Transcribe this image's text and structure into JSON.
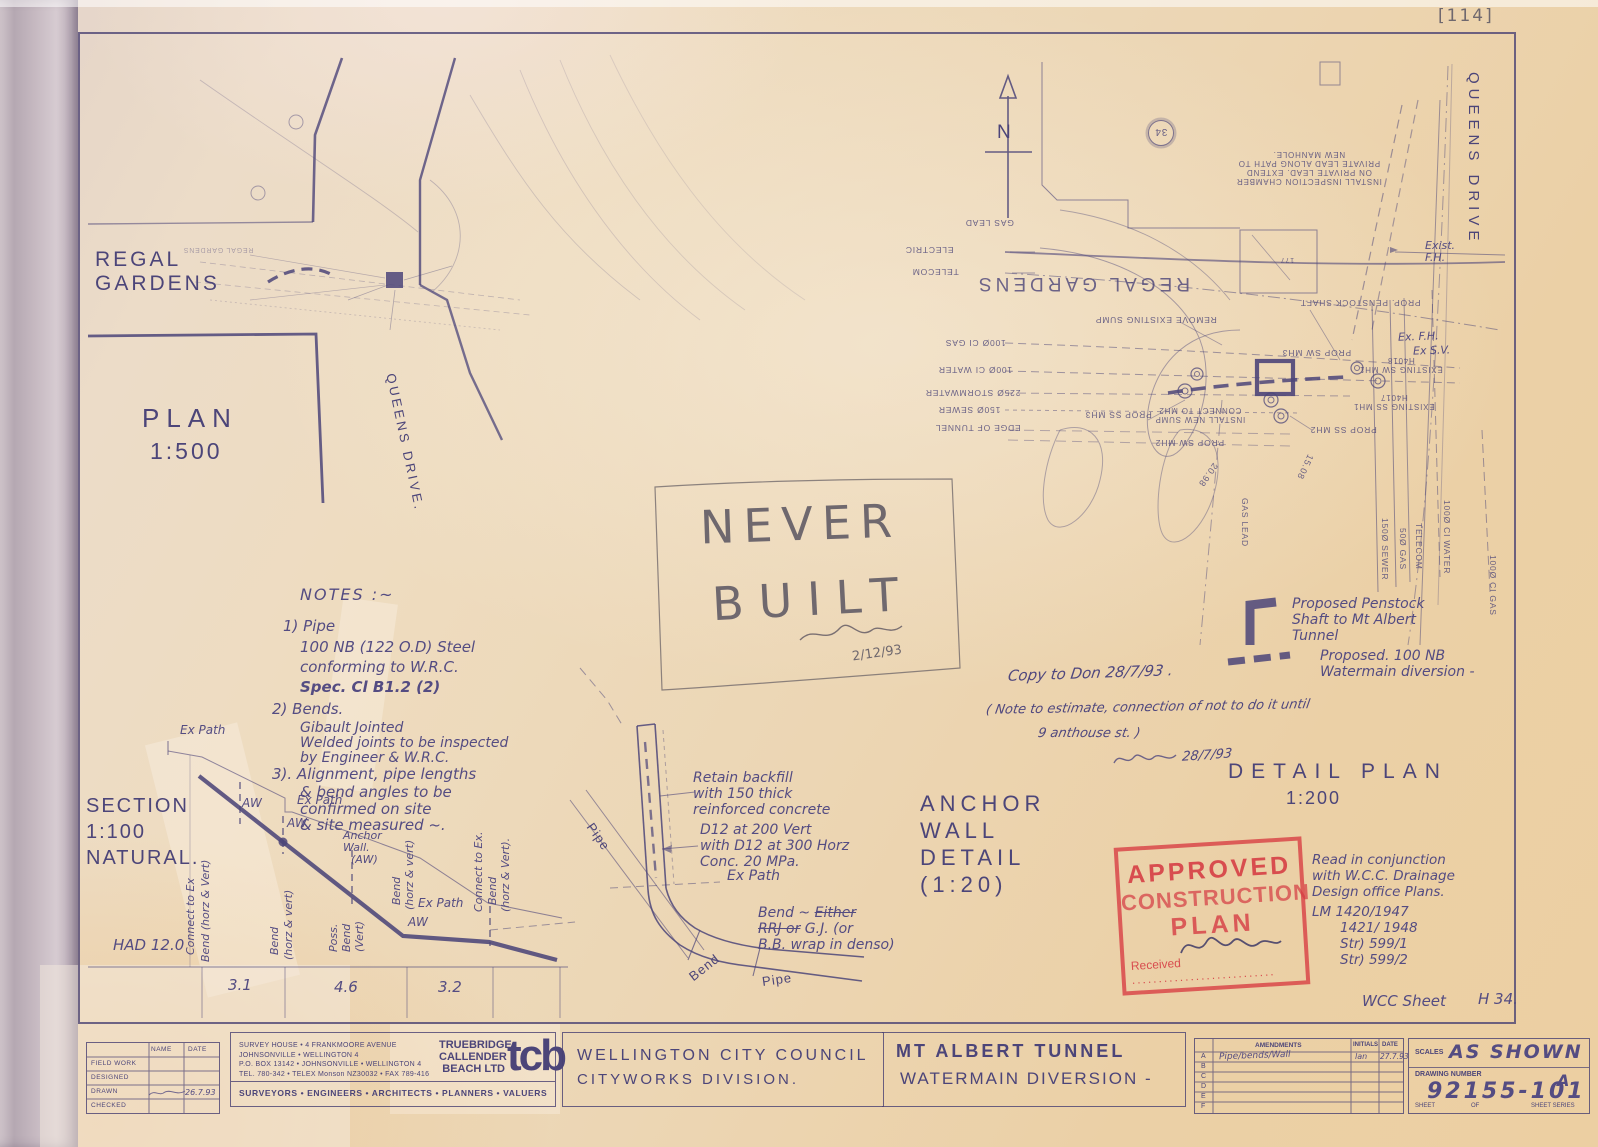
{
  "meta": {
    "pencil_ref": "[114]"
  },
  "plan500": {
    "regal_gardens_1": "REGAL",
    "regal_gardens_2": "GARDENS",
    "regal_mirror": "REGAL GARDENS",
    "title": "PLAN",
    "scale": "1:500",
    "queens_drive": "QUEENS DRIVE."
  },
  "north": {
    "label": "N"
  },
  "detail_plan": {
    "queens_drive": "QUEENS DRIVE",
    "circle_ref": "34",
    "exist_fh_1": "Exist.",
    "exist_fh_2": "F.H.",
    "ex_fh": "Ex. F.H.",
    "ex_sv": "Ex S.V.",
    "install_chamber": [
      "INSTALL INSPECTION CHAMBER",
      "ON PRIVATE LEAD. EXTEND",
      "PRIVATE LEAD ALONG PATH TO",
      "NEW MANHOLE."
    ],
    "labels": {
      "gas_lead": "GAS LEAD",
      "electric": "ELECTRIC",
      "telecom": "TELECOM",
      "regal_gardens": "REGAL GARDENS",
      "remove_sump": "REMOVE EXISTING SUMP",
      "gas100": "100Ø CI GAS",
      "water100": "100Ø CI WATER",
      "storm225": "225Ø STORMWATER",
      "sewer150": "150Ø SEWER",
      "edge_tunnel": "EDGE OF TUNNEL",
      "prop_sw_mh3": "PROP SW MH3",
      "prop_ss_mh3": "PROP SS MH3",
      "install_sump_1": "INSTALL NEW SUMP",
      "install_sump_2": "CONNECT TO MH2",
      "prop_sw_mh2": "PROP SW MH2",
      "prop_ss_mh2": "PROP SS MH2",
      "existing_sw": "EXISTING SW MH1",
      "existing_sw_id": "H4018",
      "existing_ss": "EXISTING SS MH1",
      "existing_ss_id": "H4017",
      "prop_penstock": "PROP. PENSTOCK SHAFT",
      "lvl1": "20.98",
      "lvl2": "15.08",
      "bldg": "177",
      "v_sewer150": "150Ø SEWER",
      "v_gas50": "50Ø GAS",
      "v_telecom": "TELECOM",
      "v_water100": "100Ø CI WATER",
      "v_gas100": "100Ø CI GAS",
      "v_gas_lead": "GAS LEAD"
    }
  },
  "notes": {
    "heading": "NOTES :~",
    "lines": [
      "1) Pipe",
      "100 NB (122 O.D) Steel",
      "conforming to W.R.C.",
      "Spec.  Cl  B1.2 (2)",
      "2) Bends.",
      "Gibault Jointed",
      "Welded joints to be inspected",
      "by Engineer & W.R.C.",
      "3). Alignment, pipe lengths",
      "& bend angles to be",
      "confirmed on site",
      "& site measured ~."
    ]
  },
  "never_built": {
    "word1": "NEVER",
    "word2": "BUILT",
    "date": "2/12/93"
  },
  "hand_notes": {
    "copy": "Copy to Don 28/7/93 .",
    "note_l1": "( Note to estimate, connection of not to do it until",
    "note_l2": "9 anthouse st. )",
    "sign_date": "28/7/93"
  },
  "legend": {
    "penstock": [
      "Proposed Penstock",
      "Shaft to Mt Albert",
      "Tunnel"
    ],
    "watermain": [
      "Proposed. 100 NB",
      "Watermain diversion -"
    ]
  },
  "detail_title": {
    "line1": "DETAIL  PLAN",
    "line2": "1:200"
  },
  "section": {
    "title": [
      "SECTION",
      "1:100",
      "NATURAL."
    ],
    "ex_path1": "Ex Path",
    "aw1": "AW",
    "ex_path2": "Ex Path",
    "aw2": "AW",
    "anchor_wall": [
      "Anchor",
      "Wall.",
      "(AW)"
    ],
    "ex_path3": "Ex Path",
    "aw3": "AW",
    "rot1": "Connect to Ex",
    "rot1b": "Bend (horz & Vert)",
    "rot2": "Bend",
    "rot2b": "(horz & vert)",
    "rot3": "Poss.",
    "rot3b": "Bend",
    "rot3c": "(Vert)",
    "rot4": "Bend",
    "rot4b": "(horz & vert)",
    "rot5": "Connect to Ex.",
    "rot5b": "Bend",
    "rot5c": "(horz & Vert).",
    "datum": "HAD 12.0",
    "ch1": "3.1",
    "ch2": "4.6",
    "ch3": "3.2"
  },
  "anchor_detail": {
    "title": [
      "ANCHOR",
      "WALL",
      "DETAIL",
      "(1:20)"
    ],
    "note_backfill": [
      "Retain backfill",
      "with 150 thick",
      "reinforced concrete"
    ],
    "note_reinf": [
      "D12 at 200 Vert",
      "with D12 at 300 Horz",
      "Conc.  20 MPa."
    ],
    "ex_path": "Ex Path",
    "bend_a": "Bend ~ ",
    "bend_b": "Either",
    "bend_c": "RRJ or",
    "bend_d": " G.J. (or",
    "bend_e": "B.B. wrap in denso)",
    "pipe1": "Pipe",
    "bend": "Bend",
    "pipe2": "Pipe"
  },
  "stamp": {
    "l1": "APPROVED",
    "l2": "CONSTRUCTION",
    "l3": "PLAN",
    "received": "Received"
  },
  "conjunction": [
    "Read in conjunction",
    "with  W.C.C. Drainage",
    "Design office Plans.",
    "LM 1420/1947",
    "1421/ 1948",
    "Str)    599/1",
    "Str)    599/2"
  ],
  "wcc_sheet": {
    "label": "WCC Sheet",
    "value": "H 34."
  },
  "titleblock": {
    "fieldtable": {
      "col_name": "NAME",
      "col_date": "DATE",
      "rows": [
        "FIELD WORK",
        "DESIGNED",
        "DRAWN",
        "CHECKED"
      ],
      "drawn_date": "26.7.93"
    },
    "tcb": {
      "addr": [
        "SURVEY HOUSE • 4 FRANKMOORE AVENUE",
        "JOHNSONVILLE • WELLINGTON 4",
        "P.O. BOX 13142 • JOHNSONVILLE • WELLINGTON 4",
        "TEL. 780-342 • TELEX Monson NZ30032 • FAX 789-416"
      ],
      "name": [
        "TRUEBRIDGE",
        "CALLENDER",
        "BEACH LTD"
      ],
      "logo": "tcb",
      "disciplines": "SURVEYORS   •   ENGINEERS   •   ARCHITECTS   •   PLANNERS   •   VALUERS"
    },
    "client_1": "WELLINGTON  CITY  COUNCIL",
    "client_2": "CITYWORKS   DIVISION.",
    "project_1": "MT  ALBERT  TUNNEL",
    "project_2": "WATERMAIN  DIVERSION -",
    "amendments": {
      "header": "AMENDMENTS",
      "initials": "INITIALS",
      "date": "DATE",
      "row_letters": [
        "A",
        "B",
        "C",
        "D",
        "E",
        "F"
      ],
      "rowA_text": "Pipe/bends/Wall",
      "rowA_initials": "lan",
      "rowA_date": "27.7.93"
    },
    "scales_label": "SCALES",
    "scales": "AS SHOWN",
    "dwg_label": "DRAWING NUMBER",
    "dwg": "92155-101",
    "rev": "A",
    "sheet": "SHEET",
    "of": "OF",
    "series": "SHEET SERIES"
  }
}
